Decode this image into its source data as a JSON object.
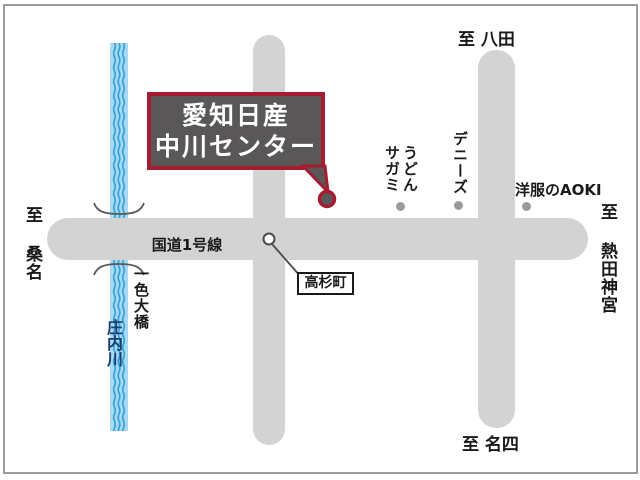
{
  "callout": {
    "line1": "愛知日産",
    "line2": "中川センター"
  },
  "roads": {
    "route1": "国道1号線"
  },
  "directions": {
    "north": "至 八田",
    "west": "至 桑名",
    "east": "至 熱田神宮",
    "south": "至 名四"
  },
  "landmarks": {
    "udon_sagami": {
      "line1": "うどん",
      "line2": "サガミ"
    },
    "dennys": "デニーズ",
    "aoki": "洋服のAOKI",
    "takasugi": "高杉町"
  },
  "river": {
    "name": "庄内川",
    "bridge": "一色大橋"
  },
  "colors": {
    "road": "#d3d3d3",
    "river_fill": "#a7d9f2",
    "river_wave": "#35a3d9",
    "callout_bg": "#595757",
    "callout_border": "#a51c30",
    "river_text": "#1c3c74",
    "landmark_dot": "#9b9b9b"
  }
}
